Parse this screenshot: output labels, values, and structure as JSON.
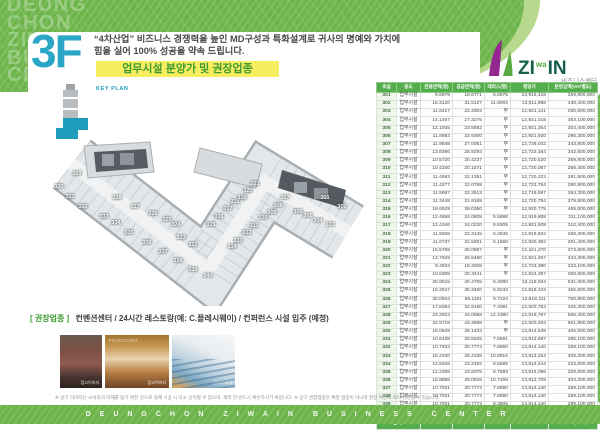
{
  "brand": {
    "vertical_words": [
      "DEUNG",
      "CHON",
      "ZIWAIN",
      "BUSINESS",
      "CENTER"
    ],
    "logo": {
      "zi": "ZI",
      "wa": "wa",
      "in": "IN",
      "subtitle": "비즈니스센터"
    }
  },
  "header": {
    "floor": "3F",
    "slogan_line1": "“4차산업” 비즈니스 경쟁력을 높인 MD구성과 특화설계로 귀사의 명예와 가치에",
    "slogan_line2": "힘을 실어 100% 성공을 약속 드립니다.",
    "title_banner": "업무시설 분양가 및 권장업종"
  },
  "keyplan": {
    "label": "KEY PLAN"
  },
  "floorplan": {
    "units": [
      {
        "no": "301",
        "x": 275,
        "y": 68
      },
      {
        "no": "302",
        "x": 292,
        "y": 77
      },
      {
        "no": "303",
        "x": 280,
        "y": 95
      },
      {
        "no": "304",
        "x": 268,
        "y": 91
      },
      {
        "no": "305",
        "x": 258,
        "y": 86
      },
      {
        "no": "306",
        "x": 248,
        "y": 82
      },
      {
        "no": "307",
        "x": 235,
        "y": 68
      },
      {
        "no": "308",
        "x": 228,
        "y": 76
      },
      {
        "no": "309",
        "x": 222,
        "y": 83
      },
      {
        "no": "310",
        "x": 213,
        "y": 88
      },
      {
        "no": "311",
        "x": 204,
        "y": 96
      },
      {
        "no": "312",
        "x": 197,
        "y": 103
      },
      {
        "no": "313",
        "x": 188,
        "y": 111
      },
      {
        "no": "314",
        "x": 182,
        "y": 117
      },
      {
        "no": "315",
        "x": 161,
        "y": 95
      },
      {
        "no": "316",
        "x": 169,
        "y": 87
      },
      {
        "no": "317",
        "x": 178,
        "y": 79
      },
      {
        "no": "318",
        "x": 185,
        "y": 72
      },
      {
        "no": "319",
        "x": 192,
        "y": 68
      },
      {
        "no": "320",
        "x": 198,
        "y": 61
      },
      {
        "no": "321",
        "x": 205,
        "y": 54
      },
      {
        "no": "322",
        "x": 143,
        "y": 115
      },
      {
        "no": "323",
        "x": 131,
        "y": 108
      },
      {
        "no": "324",
        "x": 126,
        "y": 95
      },
      {
        "no": "325",
        "x": 117,
        "y": 90
      },
      {
        "no": "326",
        "x": 103,
        "y": 84
      },
      {
        "no": "327",
        "x": 85,
        "y": 77
      },
      {
        "no": "328",
        "x": 67,
        "y": 68
      },
      {
        "no": "329",
        "x": 27,
        "y": 44
      },
      {
        "no": "330",
        "x": 9,
        "y": 57
      },
      {
        "no": "331",
        "x": 20,
        "y": 67
      },
      {
        "no": "332",
        "x": 33,
        "y": 77
      },
      {
        "no": "333",
        "x": 54,
        "y": 87
      },
      {
        "no": "334",
        "x": 66,
        "y": 93
      },
      {
        "no": "335",
        "x": 79,
        "y": 103
      },
      {
        "no": "336",
        "x": 97,
        "y": 113
      },
      {
        "no": "337",
        "x": 113,
        "y": 122
      },
      {
        "no": "338",
        "x": 128,
        "y": 131
      },
      {
        "no": "339",
        "x": 143,
        "y": 140
      },
      {
        "no": "340",
        "x": 158,
        "y": 146
      }
    ]
  },
  "table": {
    "headers": [
      "호실",
      "용도",
      "전용면적(평)",
      "공급면적(평)",
      "테라스(평)",
      "평당가",
      "분양금액(VAT별도)"
    ],
    "rows": [
      [
        "301",
        "업무시설",
        "9.6679",
        "18.6771",
        "6.6975",
        "13,915,418",
        "259,900,000"
      ],
      [
        "302",
        "업무시설",
        "16.3120",
        "31.5127",
        "11.8002",
        "13,911,898",
        "438,400,000"
      ],
      [
        "303",
        "업무시설",
        "11.6417",
        "22.4903",
        "무",
        "12,921,141",
        "290,600,000"
      ],
      [
        "304",
        "업무시설",
        "14.1497",
        "27.3276",
        "무",
        "12,921,018",
        "353,100,000"
      ],
      [
        "305",
        "업무시설",
        "12.1945",
        "23.5582",
        "무",
        "12,921,354",
        "304,400,000"
      ],
      [
        "306",
        "업무시설",
        "11.8693",
        "22.9300",
        "무",
        "12,921,920",
        "296,300,000"
      ],
      [
        "307",
        "업무시설",
        "11.9848",
        "27.0061",
        "무",
        "12,729,042",
        "343,800,000"
      ],
      [
        "308",
        "업무시설",
        "13.8396",
        "26.9294",
        "무",
        "12,722,164",
        "342,600,000"
      ],
      [
        "309",
        "업무시설",
        "10.5720",
        "20.4237",
        "무",
        "12,720,520",
        "259,800,000"
      ],
      [
        "310",
        "업무시설",
        "10.4340",
        "20.1571",
        "무",
        "12,720,087",
        "256,400,000"
      ],
      [
        "311",
        "업무시설",
        "11.4593",
        "22.1351",
        "무",
        "12,720,223",
        "281,500,000"
      ],
      [
        "312",
        "업무시설",
        "11.4277",
        "22.0768",
        "무",
        "12,723,754",
        "280,900,000"
      ],
      [
        "313",
        "업무시설",
        "11.5697",
        "22.3513",
        "무",
        "12,719,597",
        "284,300,000"
      ],
      [
        "314",
        "업무시설",
        "11.3448",
        "21.9169",
        "무",
        "12,720,794",
        "278,800,000"
      ],
      [
        "315",
        "업무시설",
        "18.6529",
        "36.0350",
        "무",
        "12,920,775",
        "465,600,000"
      ],
      [
        "316",
        "업무시설",
        "12.4658",
        "24.0808",
        "5.5888",
        "12,919,808",
        "311,100,000"
      ],
      [
        "317",
        "업무시설",
        "12.4346",
        "24.0220",
        "5.9305",
        "12,921,508",
        "310,400,000"
      ],
      [
        "318",
        "업무시설",
        "11.5508",
        "22.3145",
        "5.2635",
        "12,919,822",
        "288,300,000"
      ],
      [
        "319",
        "업무시설",
        "11.6737",
        "22.5501",
        "5.1660",
        "12,920,362",
        "291,400,000"
      ],
      [
        "320",
        "업무시설",
        "15.5769",
        "30.0887",
        "무",
        "12,421,270",
        "373,800,000"
      ],
      [
        "321",
        "업무시설",
        "13.7929",
        "26.6460",
        "무",
        "12,921,267",
        "344,300,000"
      ],
      [
        "322",
        "업무시설",
        "9.4834",
        "18.3208",
        "무",
        "12,723,380",
        "233,100,000"
      ],
      [
        "323",
        "업무시설",
        "10.5308",
        "20.3441",
        "무",
        "12,824,397",
        "260,900,000"
      ],
      [
        "324",
        "업무시설",
        "20.9515",
        "40.4755",
        "6.4090",
        "13,119,034",
        "531,000,000"
      ],
      [
        "325",
        "업무시설",
        "18.2947",
        "35.3400",
        "5.9233",
        "12,919,103",
        "456,600,000"
      ],
      [
        "326",
        "업무시설",
        "30.0944",
        "58.1191",
        "9.7223",
        "12,918,311",
        "750,800,000"
      ],
      [
        "327",
        "업무시설",
        "17.8384",
        "32.9160",
        "7.4081",
        "12,920,753",
        "425,300,000"
      ],
      [
        "328",
        "업무시설",
        "23.2923",
        "43.0658",
        "12.4380",
        "12,919,767",
        "556,400,000"
      ],
      [
        "329",
        "업무시설",
        "22.5718",
        "43.4898",
        "무",
        "12,920,263",
        "561,900,000"
      ],
      [
        "330",
        "업무시설",
        "15.0849",
        "29.1433",
        "무",
        "13,914,549",
        "405,500,000"
      ],
      [
        "331",
        "업무시설",
        "10.6438",
        "20.5625",
        "7.5591",
        "13,913,687",
        "286,100,000"
      ],
      [
        "332",
        "업무시설",
        "10.7933",
        "20.7774",
        "7.6850",
        "13,914,140",
        "289,100,000"
      ],
      [
        "333",
        "업무시설",
        "15.2340",
        "29.4108",
        "10.8915",
        "13,913,254",
        "409,200,000"
      ],
      [
        "334",
        "업무시설",
        "12.8346",
        "23.2492",
        "8.5585",
        "13,914,444",
        "323,500,000"
      ],
      [
        "335",
        "업무시설",
        "12.2308",
        "23.6075",
        "8.7583",
        "13,915,096",
        "328,500,000"
      ],
      [
        "336",
        "업무시설",
        "15.8886",
        "29.0526",
        "10.7458",
        "13,912,709",
        "404,200,000"
      ],
      [
        "337",
        "업무시설",
        "10.7931",
        "20.7774",
        "7.6850",
        "13,914,140",
        "289,100,000"
      ],
      [
        "338",
        "업무시설",
        "10.7931",
        "20.7774",
        "7.6850",
        "13,914,140",
        "289,100,000"
      ],
      [
        "339",
        "업무시설",
        "10.7931",
        "20.7774",
        "8.3806",
        "13,914,140",
        "289,100,000"
      ],
      [
        "340",
        "업무시설",
        "14.1102",
        "27.2581",
        "무",
        "13,914,601",
        "379,300,000"
      ]
    ],
    "total": {
      "label": "합계",
      "exclusive_sum": "555.2734",
      "supply_sum": "1073.7141",
      "amount_sum": "14,124,400,000"
    }
  },
  "recommend": {
    "label": "[ 권장업종 ]",
    "text": "컨벤션센터 / 24시간 레스토랑(예: C.플레시웨이) / 컨퍼런스 시설 입주 (예정)"
  },
  "photos": [
    {
      "caption": "참고이미지"
    },
    {
      "caption": "참고이미지",
      "sign": "FOODCOURT"
    },
    {
      "caption": "참고이미지"
    }
  ],
  "disclaimer": "※ 상기 이미지는 소비자의 이해를 돕기 위한 것으로 실제 시공 시 다소 상이할 수 있으며, 계약 전 반드시 확인하시기 바랍니다. ※ 상기 권장업종은 확정 업종이 아니며 현장 여건에 따라 변경될 수 있습니다.",
  "footer": {
    "brand_spaced": "DEUNGCHON ZIWAIN BUSINESS CENTER"
  },
  "colors": {
    "green": "#6db54a",
    "green_table": "#54ae4e",
    "green_light": "#b6d98e",
    "yellow_banner": "#f6ee5e",
    "title_green": "#3f9c35",
    "floor_blue": "#2ba6c6",
    "keyplan_teal": "#1e9cba",
    "logo_purple": "#93278f"
  }
}
